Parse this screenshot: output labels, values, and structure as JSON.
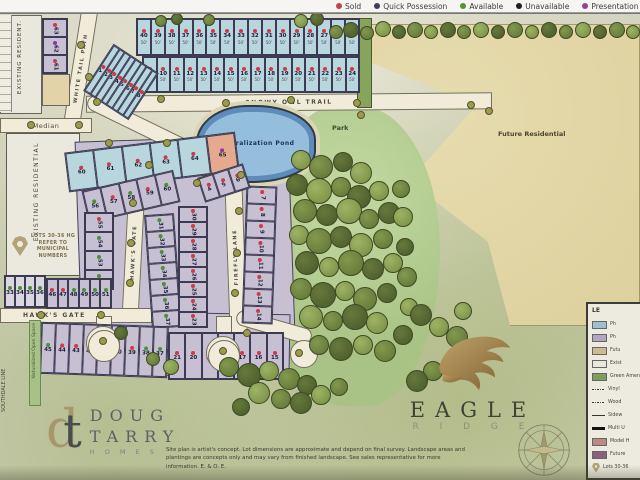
{
  "legend_bar": {
    "items": [
      {
        "label": "Sold",
        "color": "#c9404e"
      },
      {
        "label": "Quick Possession",
        "color": "#3d3d5c"
      },
      {
        "label": "Available",
        "color": "#53913c"
      },
      {
        "label": "Unavailable",
        "color": "#1f1f1f"
      },
      {
        "label": "Presentation Centre",
        "color": "#9c3f94"
      },
      {
        "label": "Other",
        "color": "#5c2b38"
      }
    ]
  },
  "status_colors": {
    "s": "#d03a48",
    "a": "#4d8f3c",
    "u": "#222222",
    "p": "#8d34a8",
    "n": "transparent"
  },
  "streets": {
    "snowy_owl": "SNOWY OWL TRAIL",
    "white_tail": "WHITE TAIL PATH",
    "hawks_gate": "HAWK'S GATE",
    "hawks_gate_v": "HAWK'S GATE",
    "firefly": "FIREFLY LANE",
    "median": "Median",
    "southdale": "SOUTHDALE LINE"
  },
  "areas": {
    "future_residential": "Future Residential",
    "park": "Park",
    "pond": "Naturalization Pond",
    "existing_residential": "EXISTING RESIDENTIAL",
    "existing_resident_top": "EXISTING RESIDENT.",
    "naturalized_open_space": "Naturalized Open Space"
  },
  "notes": {
    "pin_note": "LOTS 30-36 HG REFER TO MUNICIPAL NUMBERS"
  },
  "disclaimer": "Site plan is artist's concept.  Lot dimensions are approximate and depend on final survey.  Landscape areas and plantings are concepts only and may vary from finished landscape. See sales representative for more information.  E. & O. E.",
  "logos": {
    "doug_tarry": {
      "mono_d": "d",
      "mono_t": "t",
      "line1": "DOUG",
      "line2": "TARRY",
      "line3": "H O M E S"
    },
    "eagle_ridge": {
      "line1": "EAGLE",
      "line2": "R I D G E"
    }
  },
  "blocks": {
    "north_row_a": {
      "bg": "cyan",
      "dir": "row",
      "rot": 0,
      "wl": "50'",
      "lots": [
        [
          "40",
          "s"
        ],
        [
          "39",
          "s"
        ],
        [
          "38",
          "s"
        ],
        [
          "37",
          "s"
        ],
        [
          "36",
          "s"
        ],
        [
          "35",
          "s"
        ],
        [
          "34",
          "s"
        ],
        [
          "33",
          "s"
        ],
        [
          "32",
          "s"
        ],
        [
          "31",
          "s"
        ],
        [
          "30",
          "s"
        ],
        [
          "29",
          "s"
        ],
        [
          "28",
          "s"
        ],
        [
          "27",
          "s"
        ],
        [
          "26",
          "s"
        ],
        [
          "25",
          "s"
        ]
      ]
    },
    "north_row_b": {
      "bg": "cyan",
      "dir": "row",
      "rot": 0,
      "wl": "50'",
      "lots": [
        [
          "9",
          "s"
        ],
        [
          "10",
          "s"
        ],
        [
          "11",
          "s"
        ],
        [
          "12",
          "s"
        ],
        [
          "13",
          "s"
        ],
        [
          "14",
          "s"
        ],
        [
          "15",
          "s"
        ],
        [
          "16",
          "s"
        ],
        [
          "17",
          "s"
        ],
        [
          "18",
          "s"
        ],
        [
          "19",
          "s"
        ],
        [
          "20",
          "s"
        ],
        [
          "21",
          "s"
        ],
        [
          "22",
          "s"
        ],
        [
          "23",
          "s"
        ],
        [
          "24",
          "s"
        ]
      ]
    },
    "north_fan": {
      "bg": "cyan",
      "dir": "row",
      "rot": -33,
      "lots": [
        [
          "1",
          "s"
        ],
        [
          "2",
          "s"
        ],
        [
          "3",
          "s"
        ],
        [
          "4",
          "s"
        ],
        [
          "5",
          "s"
        ],
        [
          "6",
          "s"
        ],
        [
          "7",
          "s"
        ],
        [
          "8",
          "s"
        ]
      ]
    },
    "nw_block": {
      "bg": "purple",
      "dir": "col",
      "rot": 90,
      "lots": [
        [
          "63",
          "s"
        ],
        [
          "62",
          "p"
        ],
        [
          "61",
          "s"
        ]
      ]
    },
    "cyan_row": {
      "bg": "cyan",
      "dir": "row",
      "rot": 7,
      "lots": [
        [
          "60",
          "s"
        ],
        [
          "61",
          "s"
        ],
        [
          "62",
          "s"
        ],
        [
          "63",
          "s"
        ],
        [
          "64",
          "s"
        ],
        [
          "65",
          "p",
          "model"
        ]
      ]
    },
    "west_top_row": {
      "bg": "purple",
      "dir": "row",
      "rot": 13,
      "lots": [
        [
          "56",
          "a"
        ],
        [
          "57",
          "s"
        ],
        [
          "58",
          "a"
        ],
        [
          "59",
          "s"
        ],
        [
          "60",
          "a"
        ]
      ]
    },
    "west_col": {
      "bg": "purple",
      "dir": "col",
      "rot": 90,
      "lots": [
        [
          "55",
          "s"
        ],
        [
          "54",
          "a"
        ],
        [
          "53",
          "a"
        ],
        [
          "52",
          "a"
        ]
      ]
    },
    "west_bottom_row": {
      "bg": "purple",
      "dir": "row",
      "rot": 0,
      "lots": [
        [
          "46",
          "s"
        ],
        [
          "47",
          "s"
        ],
        [
          "48",
          "a"
        ],
        [
          "49",
          "a"
        ],
        [
          "50",
          "a"
        ],
        [
          "51",
          "a"
        ]
      ]
    },
    "far_left_row": {
      "bg": "pale",
      "dir": "row",
      "rot": 0,
      "lots": [
        [
          "33",
          "a"
        ],
        [
          "34",
          "a"
        ],
        [
          "35",
          "a"
        ],
        [
          "36",
          "a"
        ]
      ]
    },
    "mid_col_west": {
      "bg": "purple",
      "dir": "col",
      "rot": 90,
      "lots": [
        [
          "31",
          "a"
        ],
        [
          "32",
          "a"
        ],
        [
          "33",
          "a"
        ],
        [
          "34",
          "a"
        ],
        [
          "35",
          "a"
        ],
        [
          "36",
          "a"
        ],
        [
          "37",
          "a"
        ]
      ]
    },
    "mid_col_east": {
      "bg": "purple",
      "dir": "col",
      "rot": 90,
      "lots": [
        [
          "30",
          "s"
        ],
        [
          "29",
          "s"
        ],
        [
          "28",
          "s"
        ],
        [
          "27",
          "s"
        ],
        [
          "26",
          "s"
        ],
        [
          "25",
          "s"
        ],
        [
          "24",
          "s"
        ],
        [
          "23",
          "s"
        ]
      ]
    },
    "firefly_east_col": {
      "bg": "purple",
      "dir": "col",
      "rot": 90,
      "lots": [
        [
          "7",
          "s"
        ],
        [
          "8",
          "s"
        ],
        [
          "9",
          "s"
        ],
        [
          "10",
          "s"
        ],
        [
          "11",
          "s"
        ],
        [
          "12",
          "s"
        ],
        [
          "13",
          "s"
        ],
        [
          "14",
          "s"
        ]
      ]
    },
    "pond_row": {
      "bg": "purple",
      "dir": "row",
      "rot": -20,
      "lots": [
        [
          "4",
          "s"
        ],
        [
          "5",
          "s"
        ],
        [
          "6",
          "s"
        ]
      ]
    },
    "west_fan": {
      "bg": "purple",
      "dir": "row",
      "rot": 0,
      "lots": [
        [
          "45",
          "a"
        ],
        [
          "44",
          "s"
        ],
        [
          "43",
          "s"
        ],
        [
          "42",
          "s"
        ],
        [
          "41",
          "s"
        ],
        [
          "40",
          "s"
        ],
        [
          "39",
          "s"
        ],
        [
          "38",
          "a"
        ],
        [
          "37",
          "a"
        ]
      ]
    },
    "east_fan": {
      "bg": "purple",
      "dir": "row",
      "rot": 0,
      "lots": [
        [
          "21",
          "s"
        ],
        [
          "20",
          "s"
        ],
        [
          "19",
          "s"
        ],
        [
          "18",
          "s"
        ],
        [
          "17",
          "s"
        ],
        [
          "16",
          "s"
        ],
        [
          "15",
          "s"
        ]
      ]
    }
  },
  "side_legend": {
    "title": "LE",
    "items": [
      {
        "type": "swatch",
        "color": "#9cc0cf",
        "label": "Ph"
      },
      {
        "type": "swatch",
        "color": "#b2a7c2",
        "label": "Ph"
      },
      {
        "type": "swatch",
        "color": "#cdbc92",
        "label": "Futu"
      },
      {
        "type": "swatch",
        "color": "#e9e6da",
        "label": "Exist"
      },
      {
        "type": "swatch",
        "color": "#7f9f58",
        "label": "Green Amen"
      },
      {
        "type": "dots",
        "label": "Vinyl"
      },
      {
        "type": "dots",
        "label": "Wood"
      },
      {
        "type": "line",
        "label": "Sidew"
      },
      {
        "type": "lineb",
        "label": "Multi U"
      },
      {
        "type": "swatch",
        "color": "#bd8a83",
        "label": "Model H"
      },
      {
        "type": "swatch",
        "color": "#8c5f7c",
        "label": "Future"
      },
      {
        "type": "pin",
        "label": "Lots 30-36"
      }
    ]
  }
}
